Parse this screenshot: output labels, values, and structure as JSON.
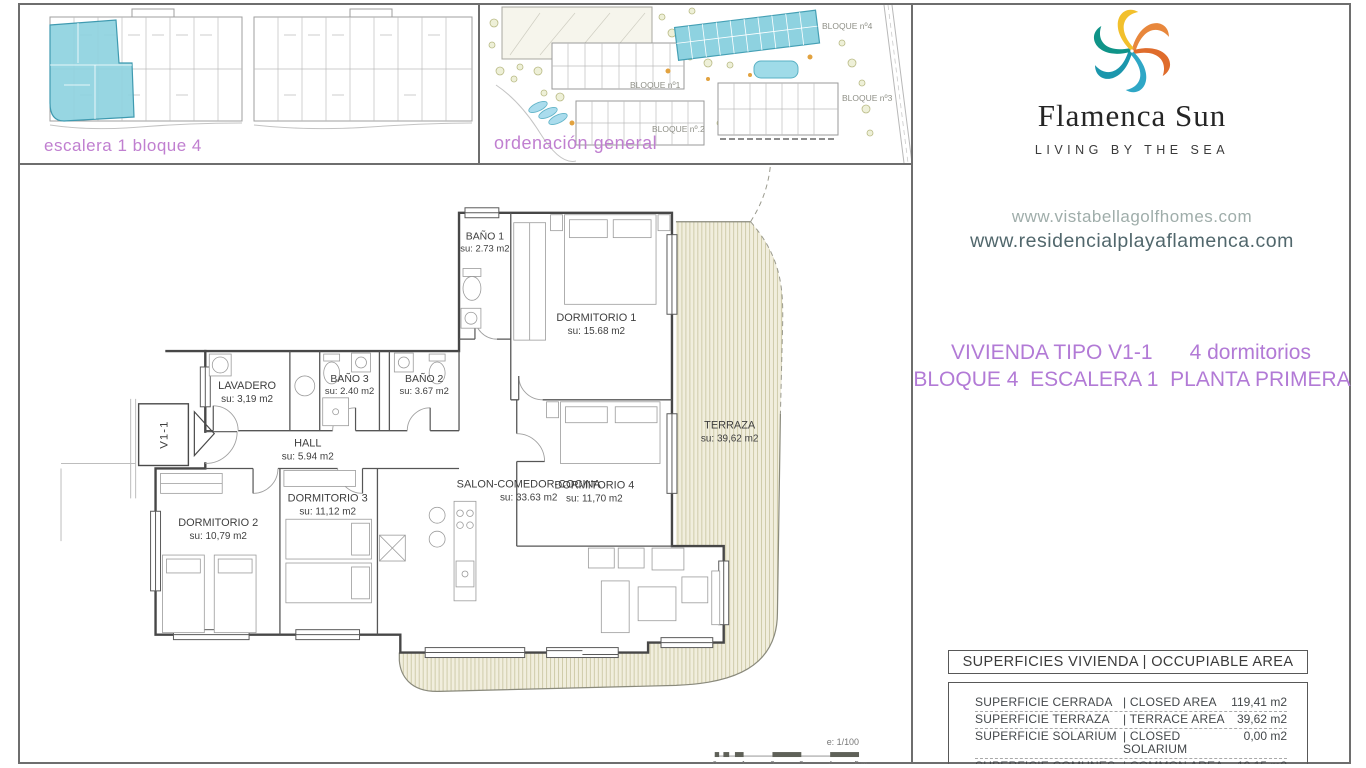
{
  "colors": {
    "accent_violet": "#b27ad6",
    "caption_violet": "#c07fd0",
    "highlight_cyan": "#8ed2e0",
    "terrace_fill": "#f1eedd",
    "logo_palette": [
      "#f2c02c",
      "#e8873c",
      "#df6c2c",
      "#2fa7c6",
      "#1b96ac",
      "#0f9488"
    ]
  },
  "panel_escalera": {
    "caption": "escalera 1 bloque 4"
  },
  "panel_ordenacion": {
    "caption": "ordenación general",
    "labels": [
      "BLOQUE nº1",
      "BLOQUE nº.2",
      "BLOQUE nº3",
      "BLOQUE nº4"
    ]
  },
  "brand": {
    "title": "Flamenca Sun",
    "tagline": "LIVING BY THE SEA",
    "url_1": "www.vistabellagolfhomes.com",
    "url_2": "www.residencialplayaflamenca.com"
  },
  "unit_info": {
    "type": "VIVIENDA TIPO V1-1",
    "bedrooms": "4 dormitorios",
    "location": "BLOQUE 4  ESCALERA 1  PLANTA PRIMERA"
  },
  "floor_plan": {
    "unit_tag": "V1-1",
    "scale_note": "e: 1/100",
    "scale_ticks": [
      "0",
      "1",
      "2",
      "3",
      "4",
      "5 m"
    ],
    "rooms": {
      "bano1": {
        "name": "BAÑO 1",
        "area": "su: 2.73 m2"
      },
      "dorm1": {
        "name": "DORMITORIO 1",
        "area": "su: 15.68 m2"
      },
      "lavadero": {
        "name": "LAVADERO",
        "area": "su: 3,19 m2"
      },
      "bano3": {
        "name": "BAÑO 3",
        "area": "su: 2.40 m2"
      },
      "bano2": {
        "name": "BAÑO 2",
        "area": "su: 3.67 m2"
      },
      "hall": {
        "name": "HALL",
        "area": "su: 5.94 m2"
      },
      "dorm4": {
        "name": "DORMITORIO 4",
        "area": "su: 11,70 m2"
      },
      "terraza": {
        "name": "TERRAZA",
        "area": "su: 39,62 m2"
      },
      "dorm2": {
        "name": "DORMITORIO 2",
        "area": "su: 10,79 m2"
      },
      "dorm3": {
        "name": "DORMITORIO 3",
        "area": "su: 11,12 m2"
      },
      "salon": {
        "name": "SALON-COMEDOR-COCINA",
        "area": "su: 33.63 m2"
      }
    }
  },
  "areas_table": {
    "header": "SUPERFICIES VIVIENDA | OCCUPIABLE AREA",
    "rows": [
      {
        "es": "SUPERFICIE CERRADA",
        "en": "| CLOSED AREA",
        "value": "119,41 m2"
      },
      {
        "es": "SUPERFICIE TERRAZA",
        "en": "| TERRACE AREA",
        "value": "39,62 m2"
      },
      {
        "es": "SUPERFICIE SOLARIUM",
        "en": "| CLOSED SOLARIUM",
        "value": "0,00 m2"
      },
      {
        "es": "SUPERFICIE COMUNES",
        "en": "| COMMON AREA",
        "value": "10,15 m2"
      }
    ]
  }
}
